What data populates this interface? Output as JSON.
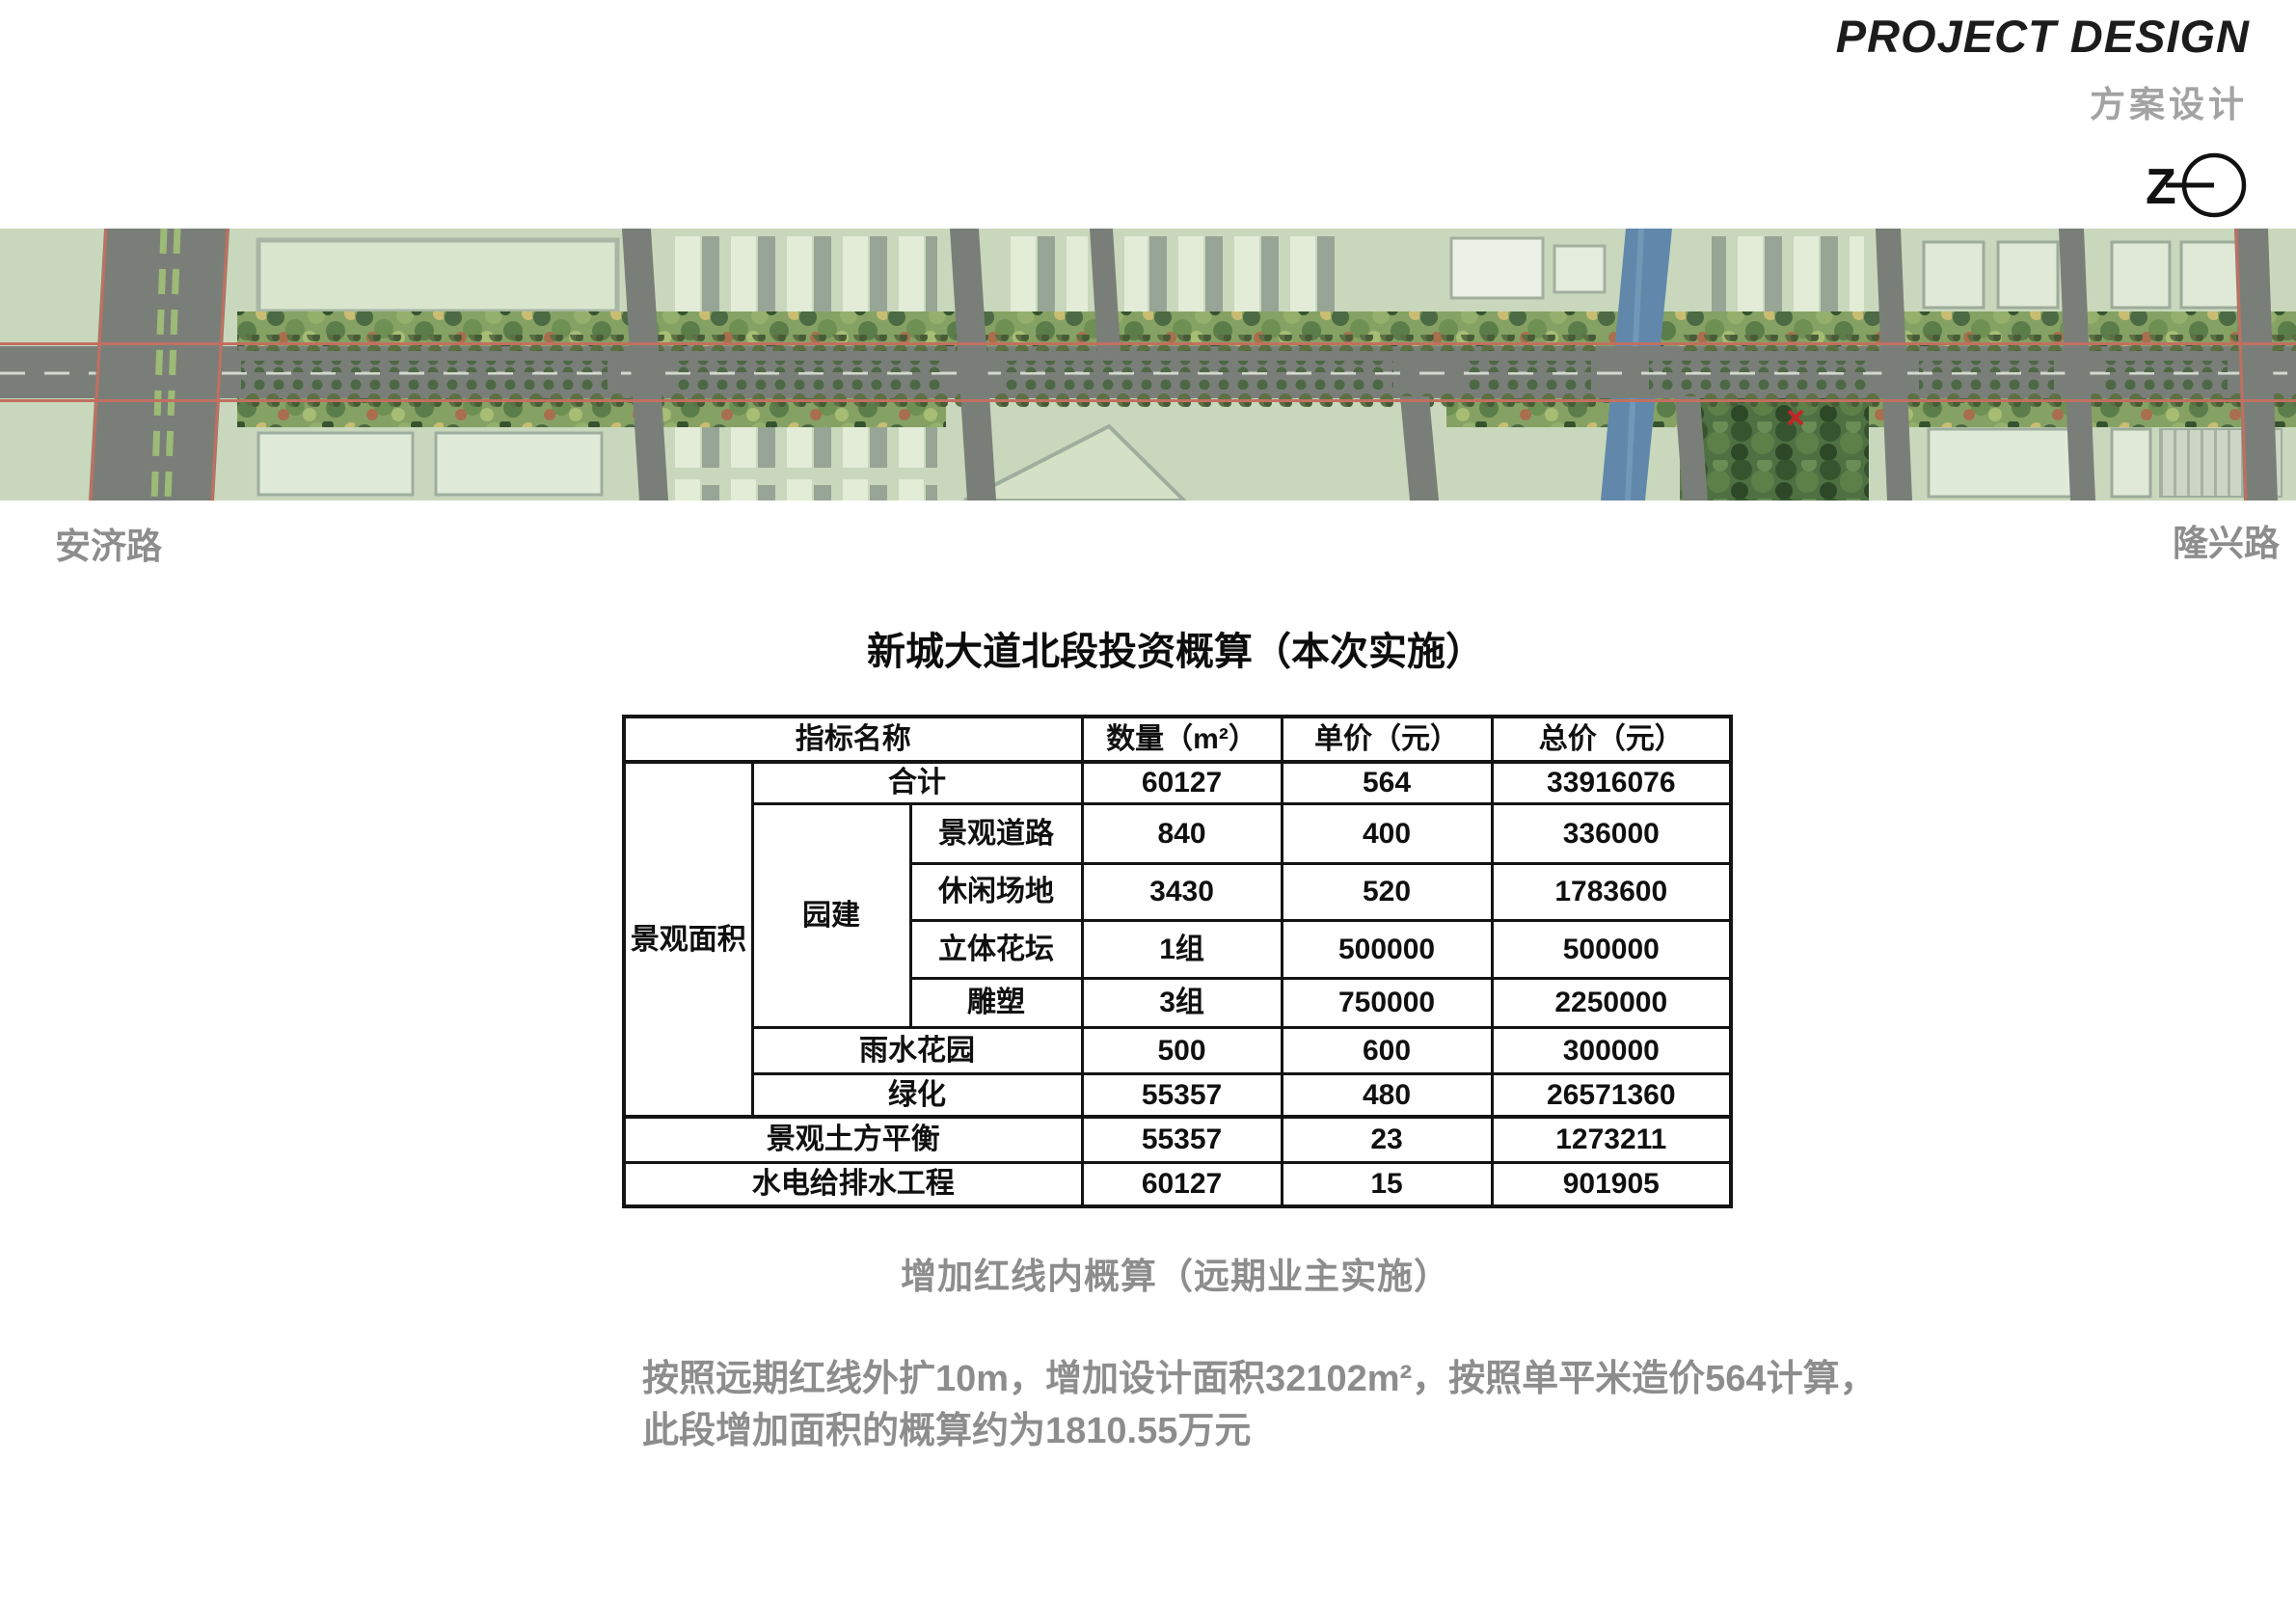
{
  "header": {
    "title_en": "PROJECT DESIGN",
    "subtitle_cn": "方案设计",
    "north_mark": "Z"
  },
  "plan": {
    "label_left": "安济路",
    "label_right": "隆兴路"
  },
  "budget_table": {
    "title": "新城大道北段投资概算（本次实施）",
    "columns": [
      "指标名称",
      "数量（m²）",
      "单价（元）",
      "总价（元）"
    ],
    "row_group": "景观面积",
    "sub_group": "园建",
    "highlight_color": "#bb2222",
    "rows": [
      {
        "label": "合计",
        "qty": "60127",
        "unit": "564",
        "total": "33916076"
      },
      {
        "label": "景观道路",
        "qty": "840",
        "unit": "400",
        "total": "336000"
      },
      {
        "label": "休闲场地",
        "qty": "3430",
        "unit": "520",
        "total": "1783600"
      },
      {
        "label": "立体花坛",
        "qty": "1组",
        "unit": "500000",
        "total": "500000"
      },
      {
        "label": "雕塑",
        "qty": "3组",
        "unit": "750000",
        "total": "2250000"
      },
      {
        "label": "雨水花园",
        "qty": "500",
        "unit": "600",
        "total": "300000"
      },
      {
        "label": "绿化",
        "qty": "55357",
        "unit": "480",
        "total": "26571360"
      },
      {
        "label": "景观土方平衡",
        "qty": "55357",
        "unit": "23",
        "total": "1273211"
      },
      {
        "label": "水电给排水工程",
        "qty": "60127",
        "unit": "15",
        "total": "901905"
      }
    ]
  },
  "notes": {
    "subtitle": "增加红线内概算（远期业主实施）",
    "body_line1": "按照远期红线外扩10m，增加设计面积32102m²，按照单平米造价564计算，",
    "body_line2": "此段增加面积的概算约为1810.55万元"
  }
}
